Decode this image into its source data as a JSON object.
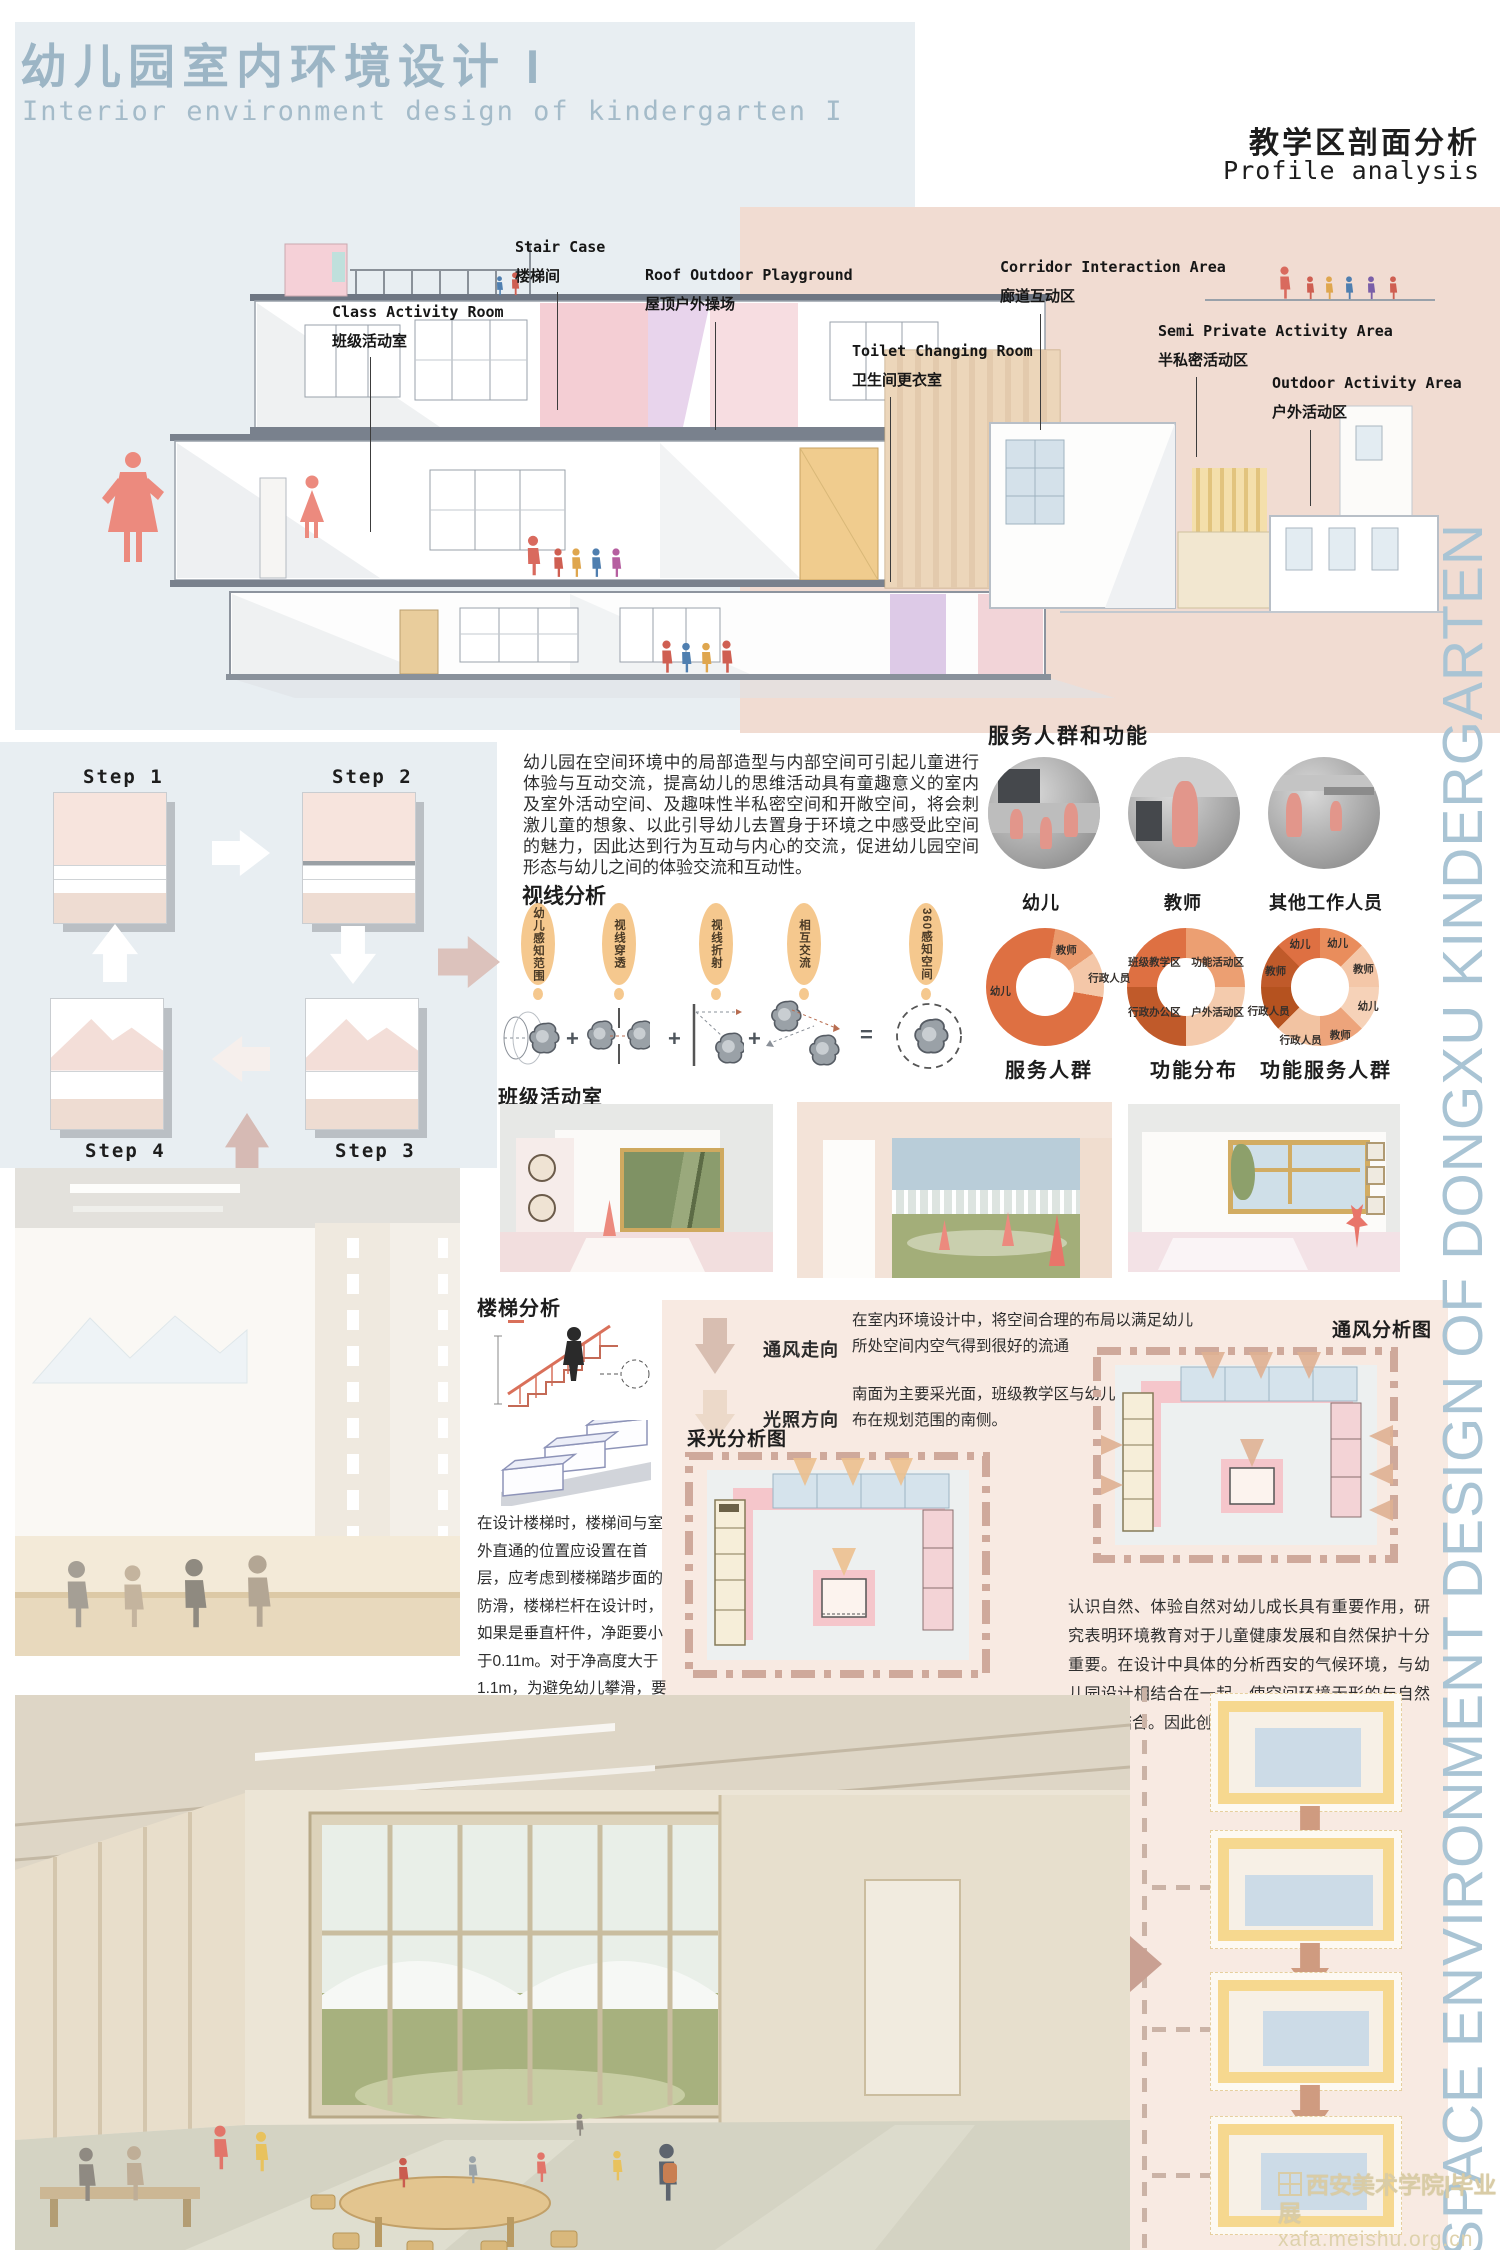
{
  "header": {
    "title_cn": "幼儿园室内环境设计 I",
    "title_en": "Interior environment design of kindergarten I",
    "section_cn": "教学区剖面分析",
    "section_en": "Profile analysis"
  },
  "section_callouts": [
    {
      "en": "Stair Case",
      "cn": "楼梯间"
    },
    {
      "en": "Class Activity Room",
      "cn": "班级活动室"
    },
    {
      "en": "Roof Outdoor Playground",
      "cn": "屋顶户外操场"
    },
    {
      "en": "Toilet Changing Room",
      "cn": "卫生间更衣室"
    },
    {
      "en": "Corridor Interaction Area",
      "cn": "廊道互动区"
    },
    {
      "en": "Semi Private Activity Area",
      "cn": "半私密活动区"
    },
    {
      "en": "Outdoor Activity Area",
      "cn": "户外活动区"
    }
  ],
  "massing_steps": {
    "step1": "Step 1",
    "step2": "Step 2",
    "step3": "Step 3",
    "step4": "Step 4"
  },
  "intro_paragraph": "幼儿园在空间环境中的局部造型与内部空间可引起儿童进行体验与互动交流，提高幼儿的思维活动具有童趣意义的室内及室外活动空间、及趣味性半私密空间和开敞空间，将会刺激儿童的想象、以此引导幼儿去置身于环境之中感受此空间的魅力，因此达到行为互动与内心的交流，促进幼儿园空间形态与幼儿之间的体验交流和互动性。",
  "sight_analysis": {
    "heading": "视线分析",
    "stages": [
      "幼儿感知范围",
      "视线穿透",
      "视线折射",
      "相互交流",
      "360感知空间"
    ],
    "operators": [
      "+",
      "+",
      "+",
      "="
    ]
  },
  "service": {
    "heading": "服务人群和功能",
    "groups": [
      "幼儿",
      "教师",
      "其他工作人员"
    ]
  },
  "classroom_heading": "班级活动室",
  "stair_analysis": {
    "heading": "楼梯分析",
    "paragraph": "在设计楼梯时，楼梯间与室外直通的位置应设置在首层，应考虑到楼梯踏步面的防滑，楼梯栏杆在设计时，如果是垂直杆件，净距要小于0.11m。对于净高度大于1.1m，为避免幼儿攀滑，要采取相关措施"
  },
  "environment": {
    "legend": [
      {
        "label": "通风走向",
        "text": "在室内环境设计中，将空间合理的布局以满足幼儿所处空间内空气得到很好的流通"
      },
      {
        "label": "光照方向",
        "text": "南面为主要采光面，班级教学区与幼儿活动主要分布在规划范围的南侧。"
      }
    ],
    "daylight_heading": "采光分析图",
    "ventilation_heading": "通风分析图",
    "nature_paragraph": "认识自然、体验自然对幼儿成长具有重要作用，研究表明环境教育对于儿童健康发展和自然保护十分重要。在设计中具体的分析西安的气候环境，与幼儿园设计相结合在一起，使空间环境无形的与自然环境相结合。因此创设适宜性建筑环境。"
  },
  "side_text": "SPACE ENVIRONMENT DESIGN OF DONGXU KINDERGARTEN",
  "watermark": {
    "line1": "西安美术学院|毕业展",
    "line2": "xafa.meishu.org.cn"
  },
  "colors": {
    "accent_salmon": "#ec8a7e",
    "panel_blue": "#e8eef2",
    "panel_pink": "#f1dcd2",
    "panel_rose": "#f8eae2",
    "title_blue": "#9cb5c5",
    "donut_dark": "#de7042",
    "frame_yellow": "#f6d88f"
  },
  "chart_data": [
    {
      "type": "donut",
      "title": "服务人群",
      "from": 10,
      "segments": [
        {
          "label": "教师",
          "value": 12.5,
          "color": "#ea9a6d",
          "la": 30,
          "r": 36
        },
        {
          "label": "行政人员",
          "value": 12.5,
          "color": "#f4c7a8",
          "la": 82,
          "r": 55
        },
        {
          "label": "幼儿",
          "value": 75,
          "color": "#de7042",
          "la": 265,
          "r": 38
        }
      ]
    },
    {
      "type": "donut",
      "title": "功能分布",
      "from": 0,
      "segments": [
        {
          "label": "功能活动区",
          "value": 25,
          "color": "#ec9f72",
          "la": 52,
          "r": 34
        },
        {
          "label": "户外活动区",
          "value": 25,
          "color": "#f4cbad",
          "la": 128,
          "r": 34
        },
        {
          "label": "行政办公区",
          "value": 25,
          "color": "#c05a2a",
          "la": 232,
          "r": 34
        },
        {
          "label": "班级教学区",
          "value": 25,
          "color": "#de7042",
          "la": 308,
          "r": 34
        }
      ]
    },
    {
      "type": "donut",
      "title": "功能服务人群",
      "from": 0,
      "segments": [
        {
          "label": "幼儿",
          "value": 12.5,
          "color": "#e98d5c",
          "la": 22,
          "r": 40
        },
        {
          "label": "教师",
          "value": 12.5,
          "color": "#f4c7a8",
          "la": 67,
          "r": 40
        },
        {
          "label": "幼儿",
          "value": 12.5,
          "color": "#f6d2b8",
          "la": 112,
          "r": 44
        },
        {
          "label": "教师",
          "value": 12.5,
          "color": "#eda47b",
          "la": 157,
          "r": 44
        },
        {
          "label": "行政人员",
          "value": 12.5,
          "color": "#f2c3a2",
          "la": 200,
          "r": 48
        },
        {
          "label": "行政人员",
          "value": 12.5,
          "color": "#b5521f",
          "la": 245,
          "r": 48
        },
        {
          "label": "教师",
          "value": 12.5,
          "color": "#c05a2a",
          "la": 290,
          "r": 40
        },
        {
          "label": "幼儿",
          "value": 12.5,
          "color": "#de7042",
          "la": 335,
          "r": 40
        }
      ]
    }
  ]
}
